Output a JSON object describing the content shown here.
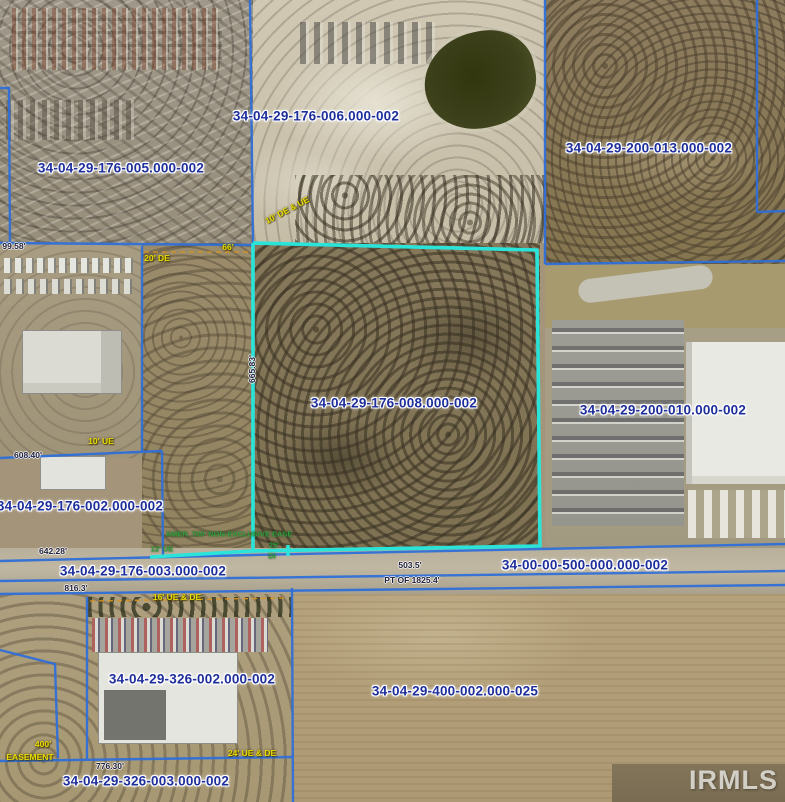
{
  "map": {
    "watermark": "IRMLS",
    "colors": {
      "boundary_blue": "#2f6fd8",
      "highlight_cyan": "#2ae4da",
      "parcel_label_text": "#1e2f9c",
      "dimension_text": "#20203a",
      "easement_yellow": "#e8dc00",
      "easement_green": "#2f9e3f",
      "easement_dash": "#d8931f"
    },
    "parcel_labels": [
      {
        "text": "34-04-29-176-006.000-002",
        "x": 316,
        "y": 116
      },
      {
        "text": "34-04-29-200-013.000-002",
        "x": 649,
        "y": 148
      },
      {
        "text": "34-04-29-176-005.000-002",
        "x": 121,
        "y": 168
      },
      {
        "text": "34-04-29-176-008.000-002",
        "x": 394,
        "y": 403
      },
      {
        "text": "34-04-29-200-010.000-002",
        "x": 663,
        "y": 410
      },
      {
        "text": "34-04-29-176-002.000-002",
        "x": 80,
        "y": 506
      },
      {
        "text": "34-04-29-176-003.000-002",
        "x": 143,
        "y": 571
      },
      {
        "text": "34-00-00-500-000.000-002",
        "x": 585,
        "y": 565
      },
      {
        "text": "34-04-29-326-002.000-002",
        "x": 192,
        "y": 679
      },
      {
        "text": "34-04-29-400-002.000-025",
        "x": 455,
        "y": 691
      },
      {
        "text": "34-04-29-326-003.000-002",
        "x": 146,
        "y": 781
      }
    ],
    "annotations": [
      {
        "text": "99.58'",
        "x": 14,
        "y": 246,
        "kind": "dim"
      },
      {
        "text": "66'",
        "x": 228,
        "y": 247,
        "kind": "yellow"
      },
      {
        "text": "20' DE",
        "x": 157,
        "y": 258,
        "kind": "yellow"
      },
      {
        "text": "10' DE & UE",
        "x": 287,
        "y": 210,
        "kind": "yellow",
        "rotate": -28
      },
      {
        "text": "665.83'",
        "x": 252,
        "y": 369,
        "kind": "dim",
        "rotate": -90
      },
      {
        "text": "10' UE",
        "x": 101,
        "y": 441,
        "kind": "yellow"
      },
      {
        "text": "608.40'",
        "x": 28,
        "y": 455,
        "kind": "dim"
      },
      {
        "text": "AMER. 700' NON-EXCLUSIVE EASE",
        "x": 229,
        "y": 534,
        "kind": "green"
      },
      {
        "text": "12' UE",
        "x": 162,
        "y": 549,
        "kind": "green"
      },
      {
        "text": "25'",
        "x": 274,
        "y": 545,
        "kind": "green"
      },
      {
        "text": "DI",
        "x": 272,
        "y": 556,
        "kind": "green"
      },
      {
        "text": "642.28'",
        "x": 53,
        "y": 551,
        "kind": "dim"
      },
      {
        "text": "503.5'",
        "x": 410,
        "y": 565,
        "kind": "dim"
      },
      {
        "text": "PT OF 1825.4'",
        "x": 412,
        "y": 580,
        "kind": "dim"
      },
      {
        "text": "816.3'",
        "x": 76,
        "y": 588,
        "kind": "dim"
      },
      {
        "text": "16' UE & DE",
        "x": 177,
        "y": 597,
        "kind": "yellow"
      },
      {
        "text": "400'",
        "x": 43,
        "y": 744,
        "kind": "yellow"
      },
      {
        "text": "EASEMENT",
        "x": 30,
        "y": 757,
        "kind": "yellow"
      },
      {
        "text": "24' UE & DE",
        "x": 252,
        "y": 753,
        "kind": "yellow"
      },
      {
        "text": "776.30'",
        "x": 110,
        "y": 766,
        "kind": "dim"
      }
    ],
    "boundaries": {
      "blue": [
        [
          [
            250,
            0
          ],
          [
            253,
            243
          ]
        ],
        [
          [
            0,
            243
          ],
          [
            253,
            245
          ]
        ],
        [
          [
            545,
            0
          ],
          [
            545,
            264
          ]
        ],
        [
          [
            545,
            264
          ],
          [
            785,
            261
          ]
        ],
        [
          [
            757,
            0
          ],
          [
            757,
            212
          ]
        ],
        [
          [
            757,
            212
          ],
          [
            785,
            211
          ]
        ],
        [
          [
            0,
            88
          ],
          [
            9,
            88
          ],
          [
            10,
            243
          ]
        ],
        [
          [
            142,
            246
          ],
          [
            142,
            452
          ]
        ],
        [
          [
            0,
            458
          ],
          [
            162,
            451
          ]
        ],
        [
          [
            162,
            451
          ],
          [
            163,
            557
          ]
        ],
        [
          [
            0,
            561
          ],
          [
            253,
            555
          ],
          [
            540,
            549
          ],
          [
            785,
            544
          ]
        ],
        [
          [
            0,
            581
          ],
          [
            785,
            571
          ]
        ],
        [
          [
            0,
            594
          ],
          [
            785,
            585
          ]
        ],
        [
          [
            87,
            597
          ],
          [
            87,
            759
          ]
        ],
        [
          [
            0,
            761
          ],
          [
            292,
            757
          ]
        ],
        [
          [
            292,
            588
          ],
          [
            293,
            802
          ]
        ],
        [
          [
            0,
            650
          ],
          [
            55,
            664
          ],
          [
            58,
            758
          ]
        ]
      ],
      "dashed": [
        [
          [
            144,
            252
          ],
          [
            250,
            252
          ]
        ],
        [
          [
            90,
            601
          ],
          [
            288,
            598
          ]
        ]
      ],
      "cyan": [
        [
          [
            253,
            243
          ],
          [
            537,
            250
          ],
          [
            540,
            546
          ],
          [
            253,
            551
          ],
          [
            253,
            243
          ]
        ],
        [
          [
            150,
            557
          ],
          [
            253,
            551
          ]
        ],
        [
          [
            288,
            545
          ],
          [
            288,
            556
          ]
        ]
      ]
    }
  }
}
